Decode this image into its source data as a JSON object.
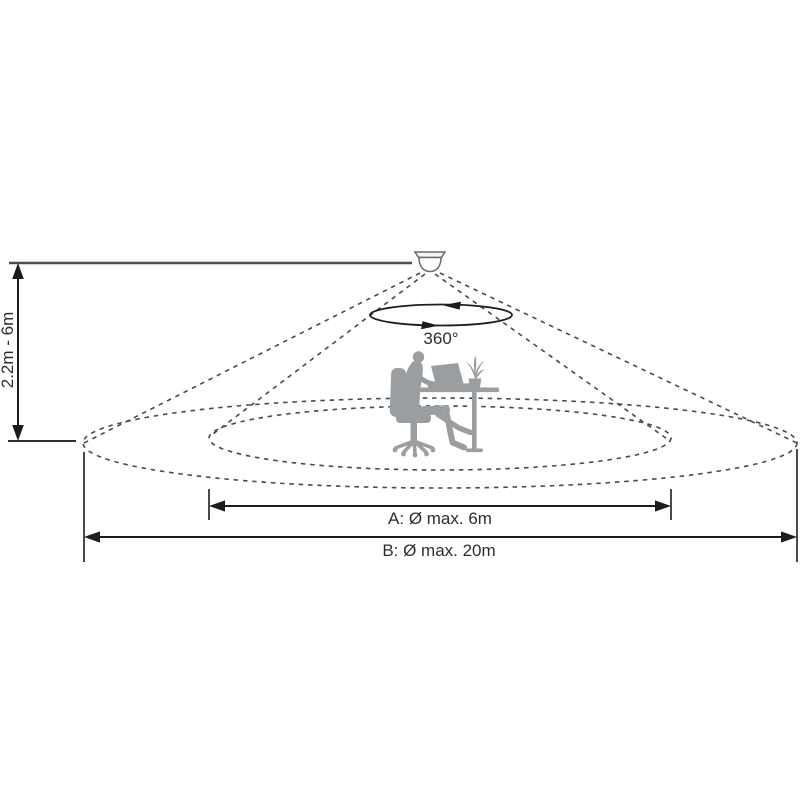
{
  "diagram": {
    "kind": "ceiling-presence-sensor-detection-range",
    "labels": {
      "height_range": "2.2m - 6m",
      "rotation": "360°",
      "diameter_a": "A: Ø max. 6m",
      "diameter_b": "B: Ø max. 20m"
    },
    "values": {
      "mounting_height_min_m": 2.2,
      "mounting_height_max_m": 6,
      "rotation_degrees": 360,
      "zone_a_max_diameter_m": 6,
      "zone_b_max_diameter_m": 20
    },
    "colors": {
      "background": "#ffffff",
      "dashed_line": "#4a4a4a",
      "dimension_line": "#1c1c1c",
      "reference_line": "#4f4f4f",
      "silhouette": "#9b9ea1",
      "text": "#2d2d2d"
    }
  }
}
